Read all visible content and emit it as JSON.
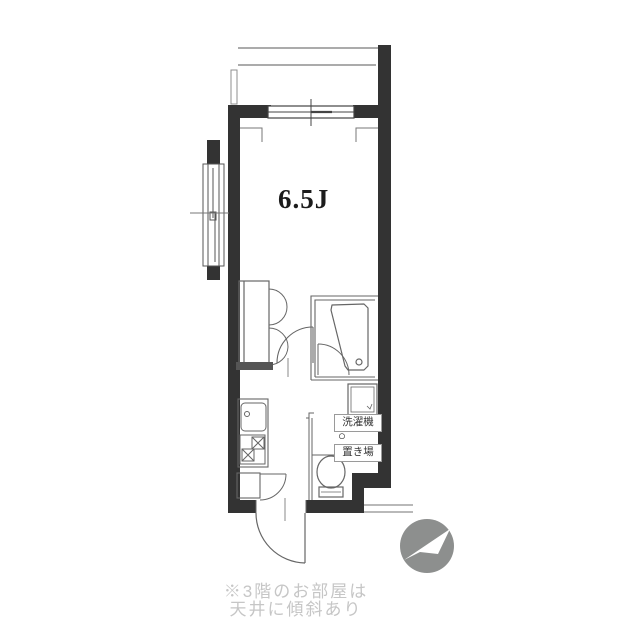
{
  "floor_plan": {
    "room": {
      "label": "6.5J"
    },
    "washer_area": {
      "line1": "洗濯機",
      "symbol": "○",
      "line2": "置き場"
    },
    "caption": {
      "line1": "※3階のお部屋は",
      "line2": "天井に傾斜あり"
    },
    "colors": {
      "wall": "#333333",
      "fixture_line": "#666666",
      "thin_line": "#8f8f8f",
      "compass_gray": "#8d8f8e",
      "caption_text": "#c6c6c6"
    }
  }
}
